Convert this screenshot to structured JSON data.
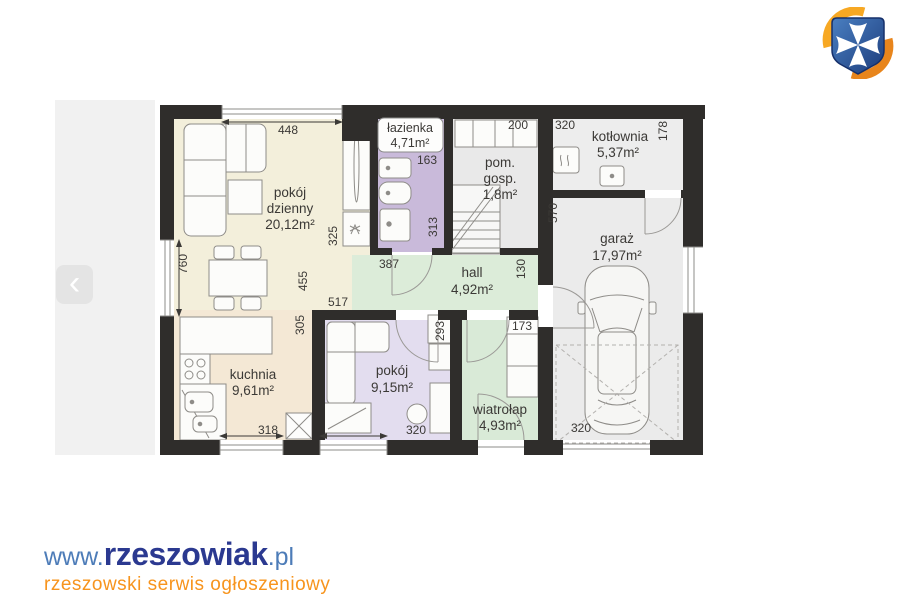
{
  "site": {
    "logo": {
      "www": "www.",
      "name": "rzeszowiak",
      "tld": ".pl",
      "tagline": "rzeszowski serwis ogłoszeniowy",
      "name_color": "#2b3990",
      "www_color": "#4d7cb8",
      "tagline_color": "#f7941d"
    },
    "crest": {
      "icon": "rzeszow-crest-icon",
      "shield_color": "#2a53a0",
      "cross_color": "#ffffff",
      "swoosh_top_color": "#f7a823",
      "swoosh_bottom_color": "#e8851c"
    }
  },
  "viewer": {
    "prev_label": "‹"
  },
  "floorplan": {
    "colors": {
      "wall": "#2f2d2b",
      "living": "#f3efdb",
      "kitchen": "#f4e8d5",
      "bath": "#c9bada",
      "small_room": "#e3ddef",
      "hall": "#dcecd9",
      "entry": "#d9ead7",
      "utility": "#e9e9e9",
      "boiler_room": "#ededed",
      "garage": "#ebebeb"
    },
    "rooms": {
      "pokoj_dzienny": {
        "l1": "pokój",
        "l2": "dzienny",
        "area": "20,12m²"
      },
      "lazienka": {
        "l1": "łazienka",
        "area": "4,71m²"
      },
      "pom_gosp": {
        "l1": "pom.",
        "l2": "gosp.",
        "area": "1,8m²"
      },
      "kotlownia": {
        "l1": "kotłownia",
        "area": "5,37m²"
      },
      "garaz": {
        "l1": "garaż",
        "area": "17,97m²"
      },
      "hall": {
        "l1": "hall",
        "area": "4,92m²"
      },
      "kuchnia": {
        "l1": "kuchnia",
        "area": "9,61m²"
      },
      "pokoj": {
        "l1": "pokój",
        "area": "9,15m²"
      },
      "wiatrolap": {
        "l1": "wiatrołap",
        "area": "4,93m²"
      }
    },
    "dims": {
      "d448": "448",
      "d760": "760",
      "d325": "325",
      "d455": "455",
      "d517": "517",
      "d163": "163",
      "d313": "313",
      "d387": "387",
      "d200": "200",
      "d130": "130",
      "d320_top": "320",
      "d178": "178",
      "d570": "570",
      "d305": "305",
      "d318": "318",
      "d293": "293",
      "d320_room": "320",
      "d173": "173",
      "d320_garage": "320"
    }
  }
}
